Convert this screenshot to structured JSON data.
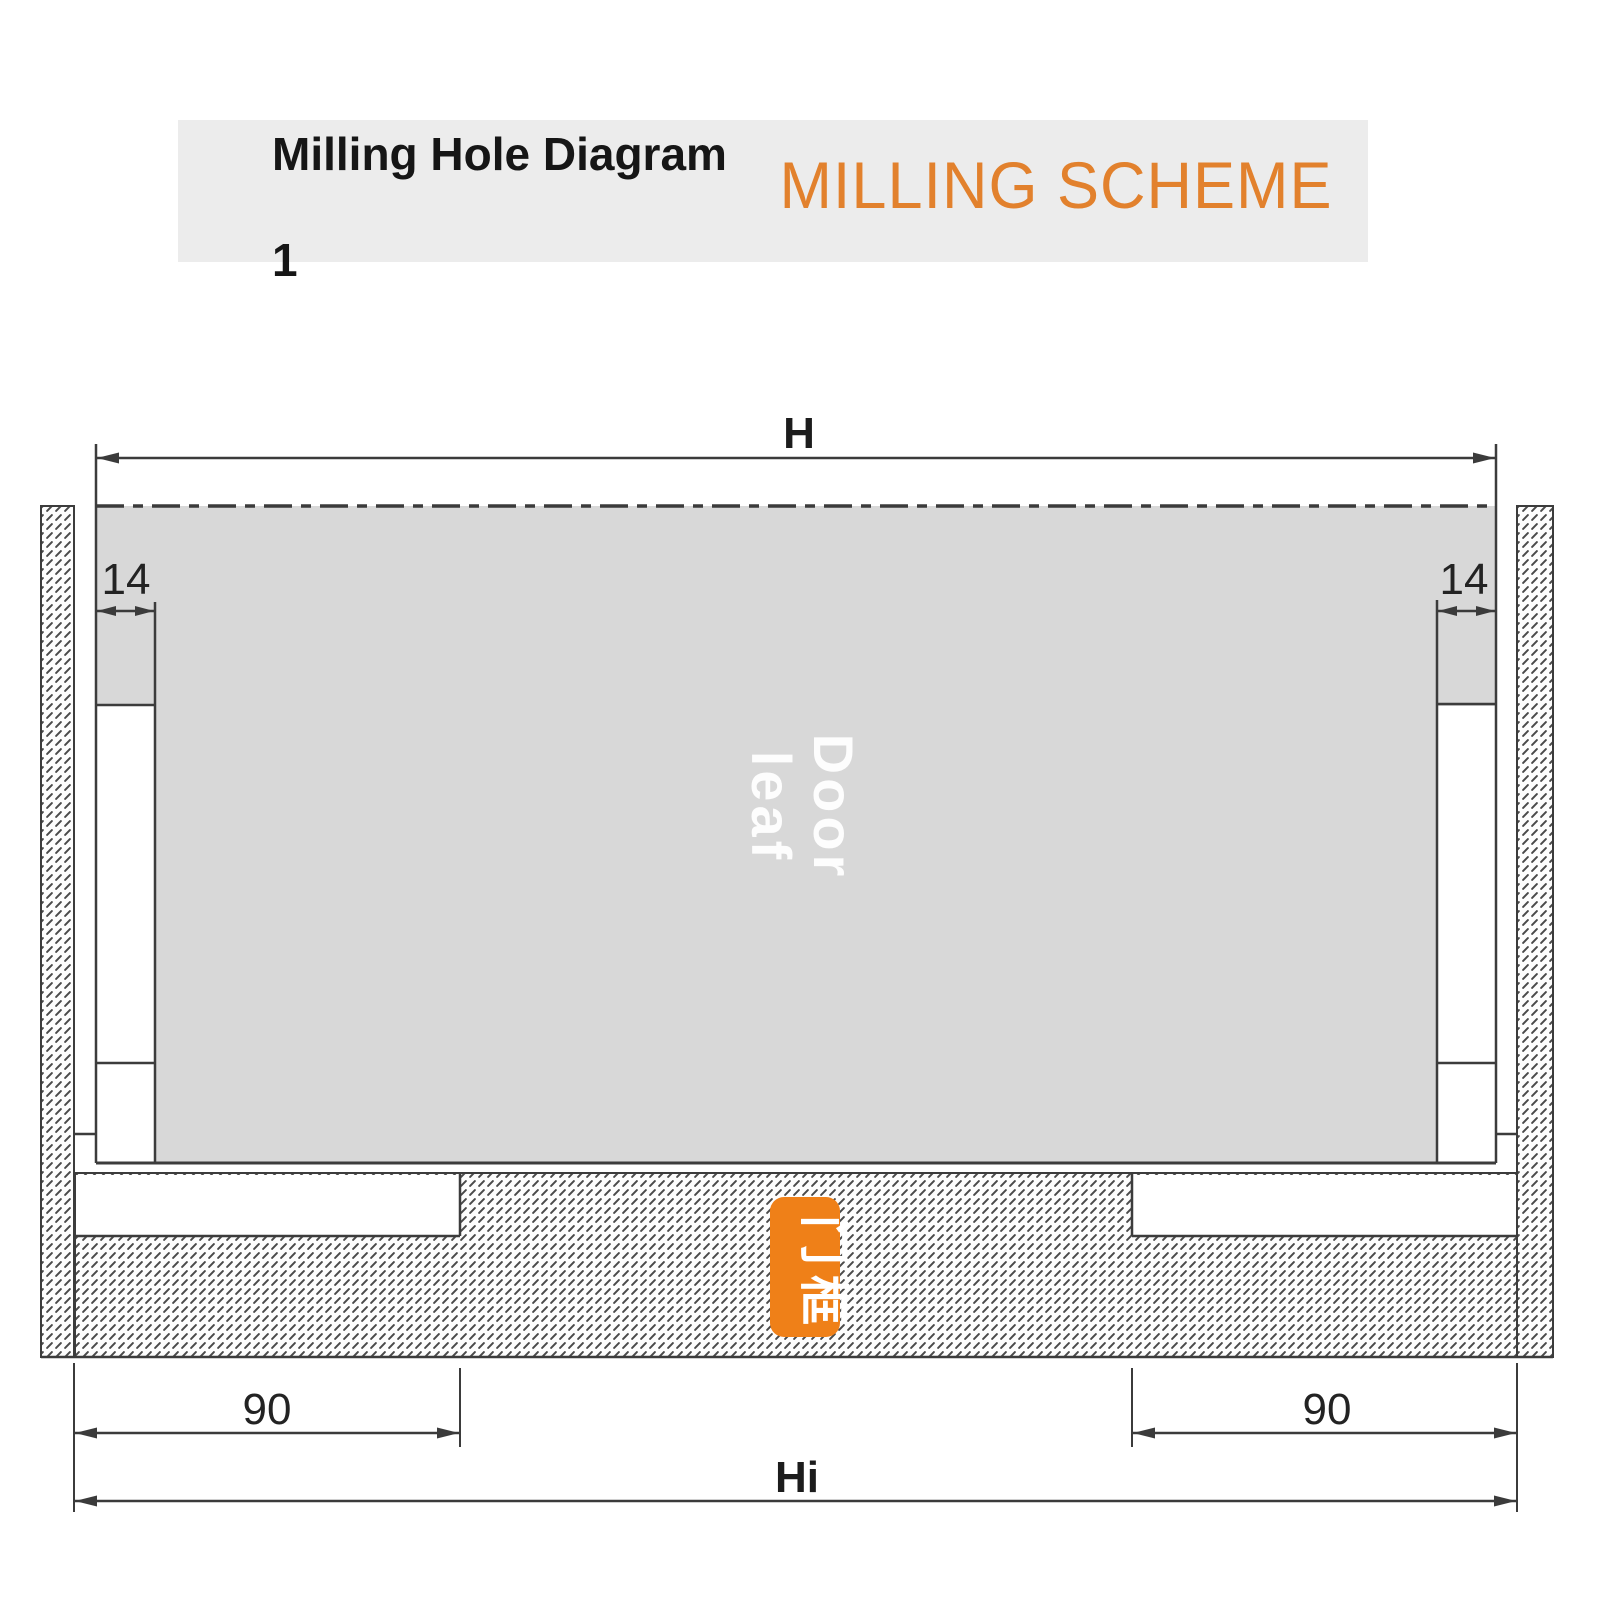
{
  "header": {
    "title_line1": "Milling Hole Diagram",
    "title_line2": "1",
    "scheme_title": "MILLING SCHEME"
  },
  "diagram": {
    "door_label_line1": "Door",
    "door_label_line2": "leaf",
    "stamp_text": "门框",
    "dimensions": {
      "top_width": "H",
      "edge_offset_left": "14",
      "edge_offset_right": "14",
      "notch_left": "90",
      "notch_right": "90",
      "inner_width": "Hi"
    },
    "colors": {
      "accent_orange": "#E2812D",
      "stamp_orange": "#EF8018",
      "door_fill": "#D8D8D8",
      "line": "#3C3C3C",
      "header_bg": "#ECECEC"
    }
  }
}
